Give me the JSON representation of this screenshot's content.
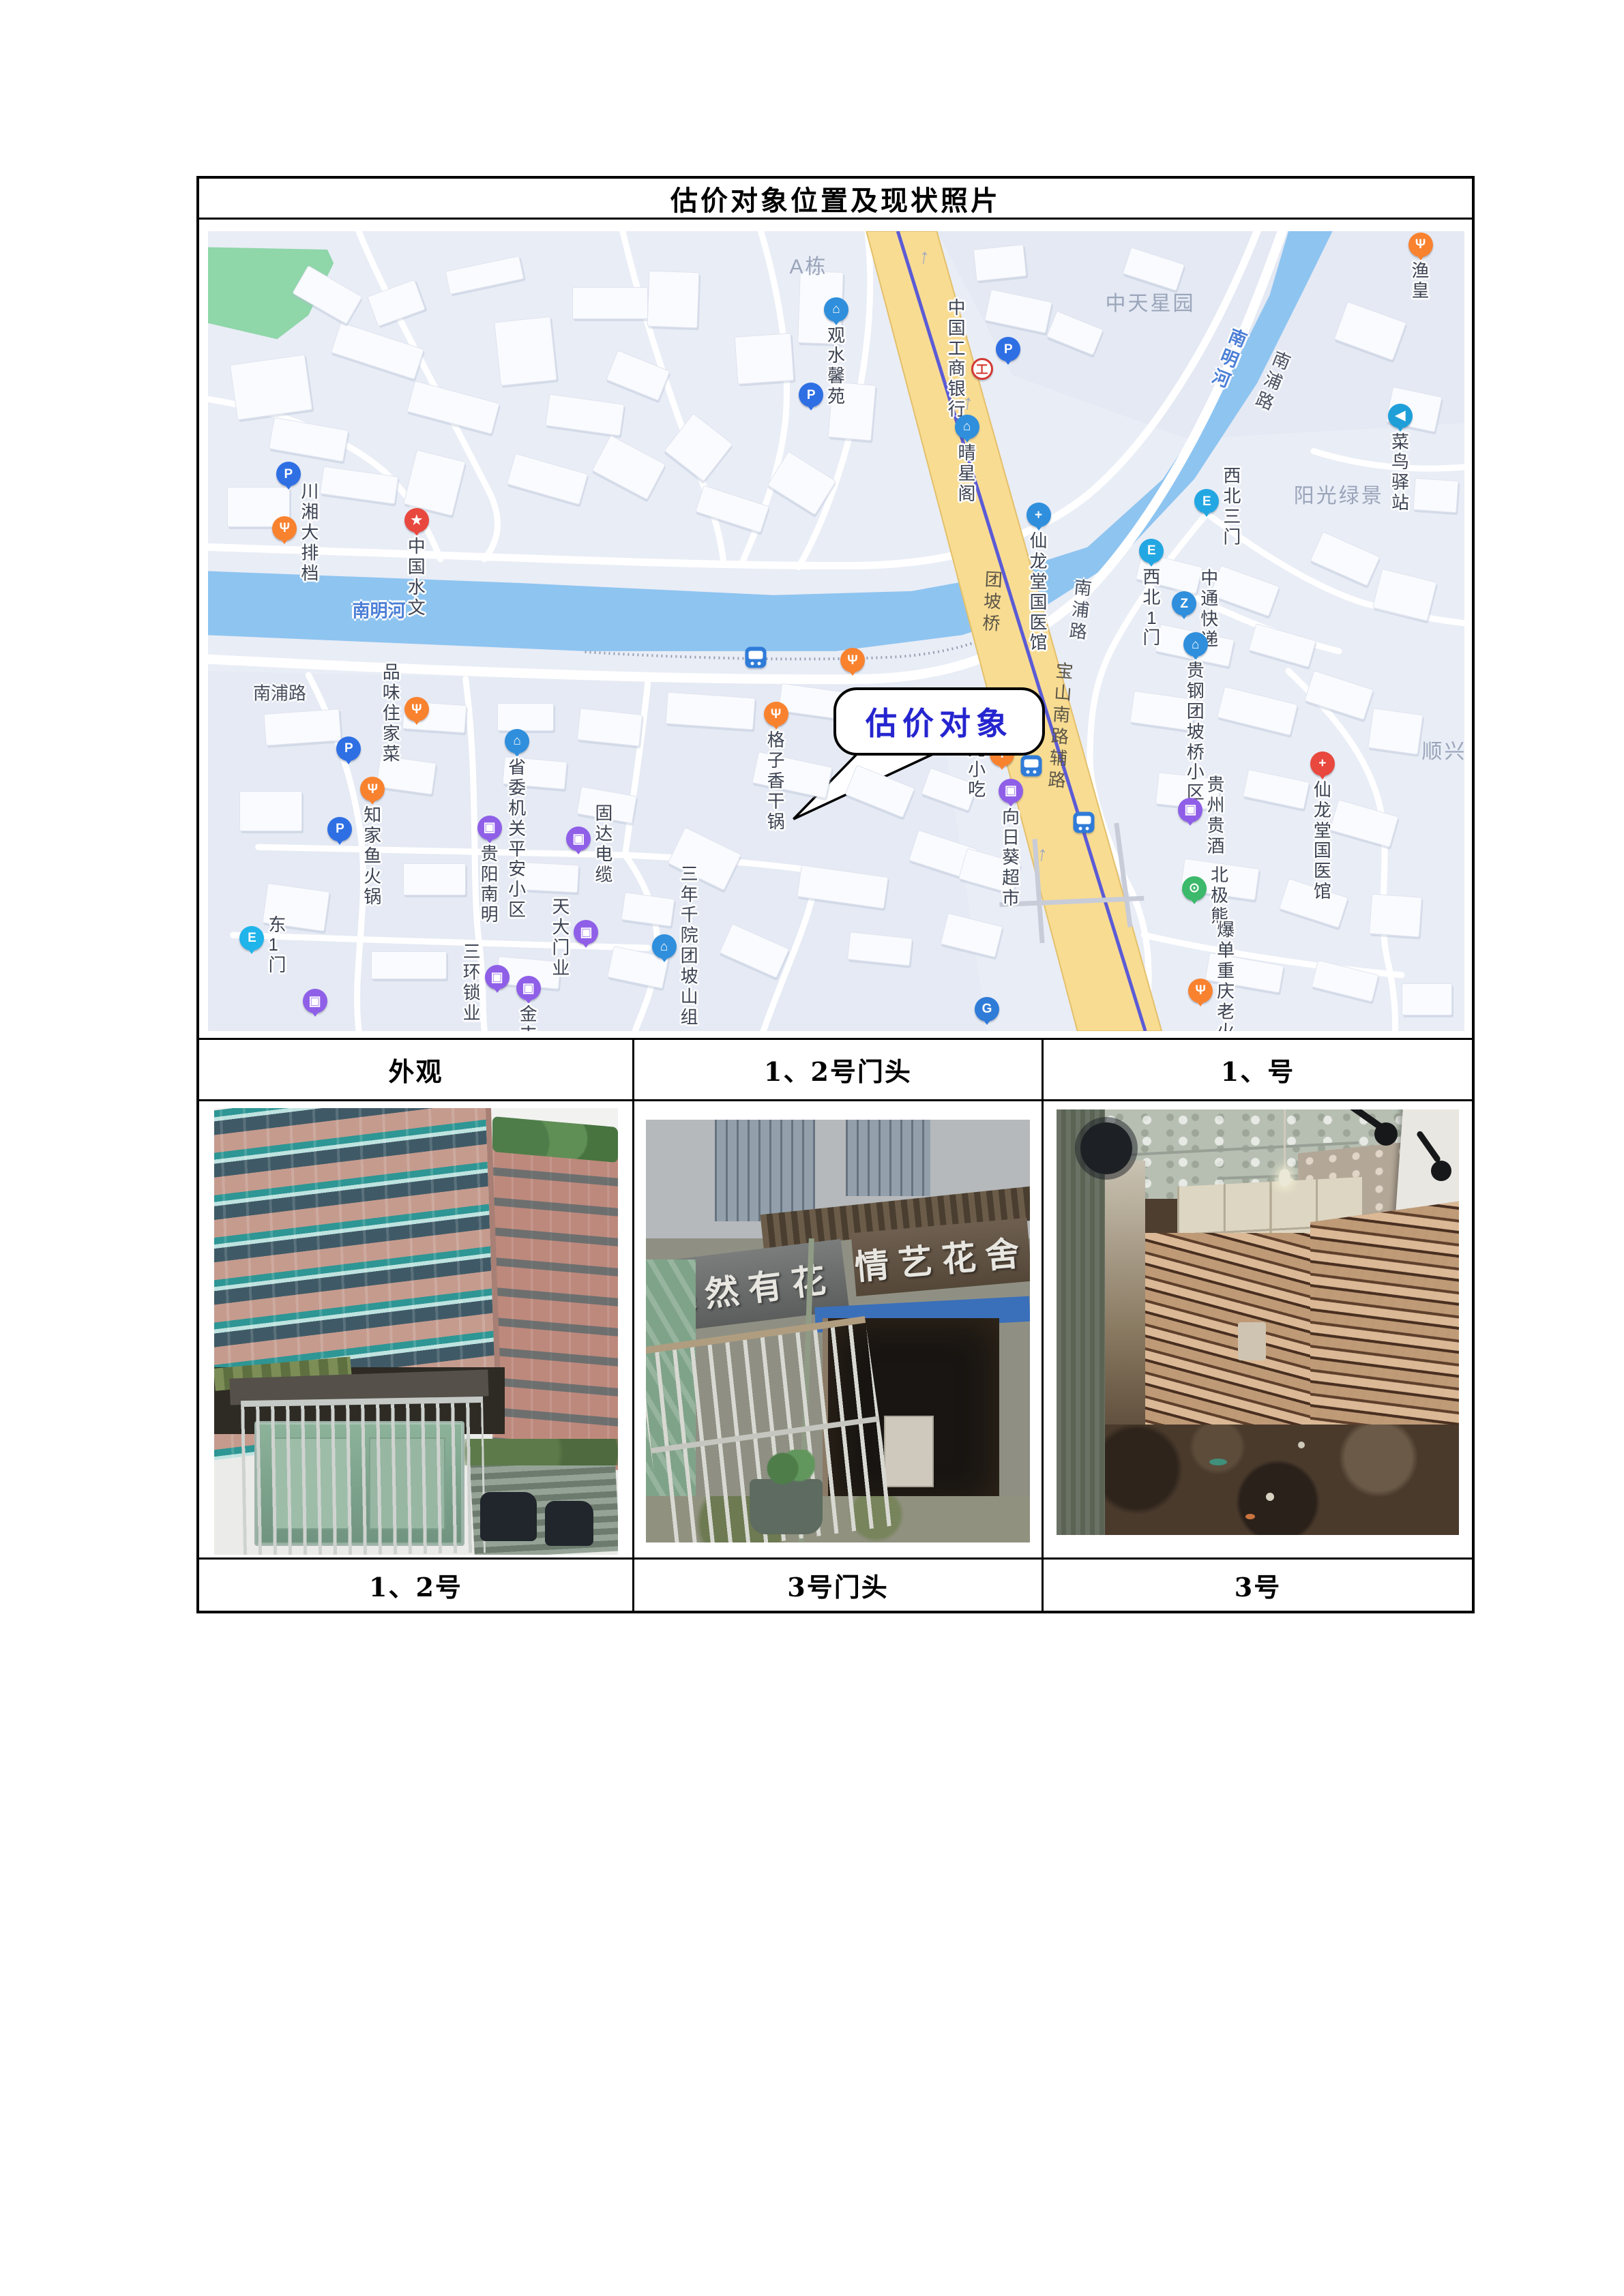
{
  "title": "估价对象位置及现状照片",
  "map": {
    "callout": "估价对象",
    "pois": [
      {
        "t": "parking",
        "x": 6.4,
        "y": 31.9
      },
      {
        "t": "food",
        "x": 6.1,
        "y": 38.7,
        "l": "川湘大排档",
        "p": "r"
      },
      {
        "t": "star-red",
        "x": 16.6,
        "y": 37.7,
        "l": "中国水文",
        "p": "b"
      },
      {
        "t": "building",
        "x": 50.0,
        "y": 11.3,
        "l": "观水馨苑",
        "p": "b"
      },
      {
        "t": "icbc",
        "x": 61.6,
        "y": 17.2,
        "l": "中国工商银行",
        "p": "l"
      },
      {
        "t": "parking",
        "x": 63.7,
        "y": 16.3
      },
      {
        "t": "parking",
        "x": 48.0,
        "y": 22.0
      },
      {
        "t": "building",
        "x": 60.4,
        "y": 26.0,
        "l": "晴星阁",
        "p": "b"
      },
      {
        "t": "medical-blue",
        "x": 66.1,
        "y": 37.0,
        "l": "仙龙堂国医馆",
        "p": "b"
      },
      {
        "t": "food",
        "x": 96.5,
        "y": 3.2,
        "l": "渔皇",
        "p": "b"
      },
      {
        "t": "cainiao",
        "x": 94.9,
        "y": 24.6,
        "l": "菜鸟驿站",
        "p": "b"
      },
      {
        "t": "gate",
        "x": 79.5,
        "y": 35.3,
        "l": "西北三门",
        "p": "r"
      },
      {
        "t": "gate",
        "x": 75.1,
        "y": 41.5,
        "l": "西北1门",
        "p": "b"
      },
      {
        "t": "zto",
        "x": 77.7,
        "y": 48.1,
        "l": "中通快递",
        "p": "r"
      },
      {
        "t": "building",
        "x": 78.6,
        "y": 53.2,
        "l": "贵钢团坡桥小区",
        "p": "b"
      },
      {
        "t": "medical-red",
        "x": 88.7,
        "y": 68.1,
        "l": "仙龙堂国医馆",
        "p": "b"
      },
      {
        "t": "cart",
        "x": 78.2,
        "y": 73.9,
        "l": "贵州贵酒",
        "p": "r"
      },
      {
        "t": "bear",
        "x": 78.5,
        "y": 83.7,
        "l": "北极熊",
        "p": "r"
      },
      {
        "t": "food",
        "x": 79.0,
        "y": 96.5,
        "l": "爆单重庆老火锅",
        "p": "r"
      },
      {
        "t": "bus",
        "x": 43.6,
        "y": 53.3
      },
      {
        "t": "food",
        "x": 51.3,
        "y": 55.2
      },
      {
        "t": "food",
        "x": 45.2,
        "y": 61.9,
        "l": "格子香干锅",
        "p": "b"
      },
      {
        "t": "food",
        "x": 63.2,
        "y": 66.9,
        "l": "宏光小吃",
        "p": "l"
      },
      {
        "t": "bus",
        "x": 65.5,
        "y": 66.8
      },
      {
        "t": "cart",
        "x": 63.9,
        "y": 71.5,
        "l": "向日葵超市",
        "p": "b"
      },
      {
        "t": "bus",
        "x": 69.7,
        "y": 73.9
      },
      {
        "t": "food",
        "x": 16.6,
        "y": 61.3,
        "l": "品味住家菜",
        "p": "l"
      },
      {
        "t": "parking",
        "x": 11.2,
        "y": 66.2
      },
      {
        "t": "food",
        "x": 13.1,
        "y": 71.3,
        "l": "知家鱼火锅",
        "p": "b"
      },
      {
        "t": "building",
        "x": 24.6,
        "y": 65.3,
        "l": "省委机关\n平安小区",
        "p": "b"
      },
      {
        "t": "parking",
        "x": 10.5,
        "y": 76.3
      },
      {
        "t": "cart",
        "x": 22.4,
        "y": 76.1,
        "l": "贵阳南明",
        "p": "b"
      },
      {
        "t": "cart",
        "x": 29.5,
        "y": 77.5,
        "l": "固达电缆",
        "p": "r"
      },
      {
        "t": "gate-cyan",
        "x": 3.5,
        "y": 89.9,
        "l": "东1门",
        "p": "r"
      },
      {
        "t": "cart",
        "x": 30.1,
        "y": 89.2,
        "l": "天大门业",
        "p": "l"
      },
      {
        "t": "cart",
        "x": 23.0,
        "y": 94.8,
        "l": "三环锁业",
        "p": "l"
      },
      {
        "t": "cart",
        "x": 25.5,
        "y": 96.2,
        "l": "金丰门窗",
        "p": "b"
      },
      {
        "t": "cart",
        "x": 8.5,
        "y": 97.8
      },
      {
        "t": "building",
        "x": 36.3,
        "y": 91.0,
        "l": "三年千院团\n坡山组",
        "p": "r"
      },
      {
        "t": "gas",
        "x": 62.0,
        "y": 98.8
      }
    ],
    "road_labels": [
      {
        "l": "南明河",
        "x": 13.6,
        "y": 47.3,
        "k": "river"
      },
      {
        "l": "南明河",
        "x": 81.2,
        "y": 16.0,
        "k": "river",
        "v": 1,
        "r": 22
      },
      {
        "l": "南浦路",
        "x": 84.7,
        "y": 18.8,
        "k": "road",
        "v": 1,
        "r": 22
      },
      {
        "l": "南浦路",
        "x": 5.7,
        "y": 57.6,
        "k": "road"
      },
      {
        "l": "南浦路",
        "x": 69.4,
        "y": 47.5,
        "k": "road",
        "v": 1,
        "r": 6
      },
      {
        "l": "团坡桥",
        "x": 62.4,
        "y": 46.5,
        "k": "road-on",
        "v": 1,
        "r": 3
      },
      {
        "l": "宝山南路辅路",
        "x": 67.8,
        "y": 62.0,
        "k": "road-on",
        "v": 1,
        "r": 4
      }
    ],
    "area_labels": [
      {
        "l": "A栋",
        "x": 47.8,
        "y": 4.2
      },
      {
        "l": "中天星园",
        "x": 75.0,
        "y": 8.8
      },
      {
        "l": "阳光绿景",
        "x": 90.0,
        "y": 32.8
      },
      {
        "l": "顺兴",
        "x": 98.4,
        "y": 64.8
      }
    ],
    "arrows": [
      {
        "x": 57.0,
        "y": 3.2
      },
      {
        "x": 60.5,
        "y": 21.5
      },
      {
        "x": 66.4,
        "y": 77.9
      }
    ]
  },
  "table": {
    "headers": [
      "外观",
      "1、2号门头",
      "1、号"
    ],
    "captions": [
      "1、2号",
      "3号门头",
      "3号"
    ]
  },
  "photos": {
    "exterior": {
      "name": "小区外观照片"
    },
    "storefront": {
      "sign_left": "果然有花",
      "sign_right": "情艺花舍"
    },
    "interior": {
      "name": "3号房屋内部照片"
    }
  },
  "colors": {
    "callout_text": "#2525cf",
    "river": "#8ec4f0",
    "main_road": "#f8dc92",
    "metro_line": "#5b5bd6",
    "poi_food": "#f9822f",
    "poi_parking": "#2f6fe4",
    "poi_shop": "#8f5fe8",
    "poi_building": "#2f8fdc",
    "poi_green": "#3cb96b",
    "poi_red": "#e8483e"
  }
}
